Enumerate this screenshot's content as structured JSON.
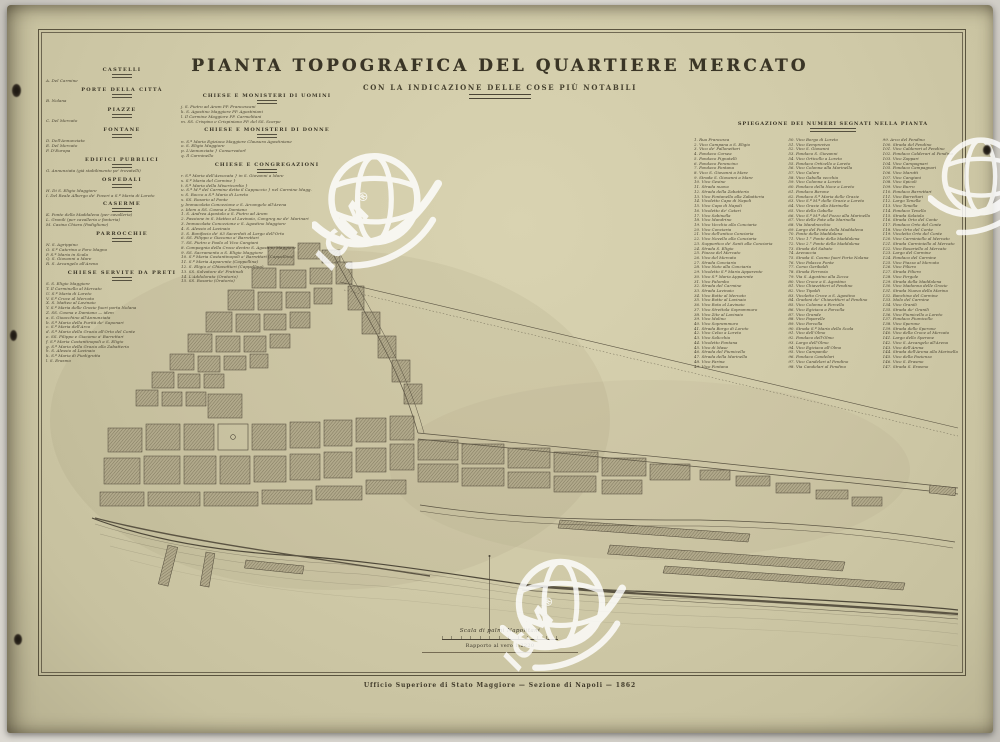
{
  "title": {
    "main": "PIANTA TOPOGRAFICA DEL QUARTIERE MERCATO",
    "subtitle": "CON LA INDICAZIONE DELLE COSE PIÙ NOTABILI"
  },
  "legend_left": {
    "sections": [
      {
        "title": "CASTELLI",
        "items": [
          "A. Del Carmine"
        ]
      },
      {
        "title": "PORTE DELLA CITTÀ",
        "items": [
          "B. Nolana"
        ]
      },
      {
        "title": "PIAZZE",
        "items": [
          "C. Del Mercato"
        ]
      },
      {
        "title": "FONTANE",
        "items": [
          "D. Dell'Annunziata",
          "E. Del Mercato",
          "F. D'Europa"
        ]
      },
      {
        "title": "EDIFICI PUBBLICI",
        "items": [
          "G. Annunziata (già stabilimento pe' trovatelli)"
        ]
      },
      {
        "title": "OSPEDALI",
        "items": [
          "H. Di S. Eligio Maggiore",
          "I. Del Reale Albergo de' Poveri a S.ª Maria di Loreto"
        ]
      },
      {
        "title": "CASERME",
        "items": [
          "K. Ponte della Maddalena (per cavalleria)",
          "L. Granili (per cavalleria e fanteria)",
          "M. Casina Chiara (Padiglione)"
        ]
      },
      {
        "title": "PARROCCHIE",
        "items": [
          "N. S. Agrippino",
          "O. S.ª Caterina a Foro Magno",
          "P. S.ª Maria in Scala",
          "Q. S. Giovanni a Mare",
          "R. S. Arcangelo all'Arena"
        ]
      },
      {
        "title": "CHIESE SERVITE DA PRETI",
        "items": [
          "S. S. Eligio Maggiore",
          "T. Il Carminello al Mercato",
          "U. S.ª Maria di Loreto",
          "V. S.ª Croce al Mercato",
          "X. S. Matteo al Lavinaio",
          "Y. S.ª Maria delle Grazie fuori porta Nolana",
          "Z. SS. Cosma e Damiano — idem",
          "a. S. Gioacchino all'Annunziata",
          "b. S.ª Maria della Purità de' Saponari",
          "c. S.ª Maria dell'Arco",
          "d. S.ª Maria della Grazia all'Orto del Conte",
          "e. SS. Filippo e Giacomo a' Barrettari",
          "f. S.ª Maria Costantinopoli a S. Eligio",
          "g. S.ª Maria della Grazia alla Zabatteria",
          "h. S. Alessio al Lavinaio",
          "k. S.ª Maria di Piedigrotta",
          "l. S. Erasmo"
        ]
      }
    ]
  },
  "center_lists": {
    "sections": [
      {
        "title": "CHIESE E MONISTERI DI UOMINI",
        "items": [
          "j. S. Pietro ad Aram PP. Francescani",
          "k. S. Agostino Maggiore PP. Agostiniani",
          "l. Il Carmine Maggiore PP. Carmelitani",
          "m. SS. Crispino e Crispiniano PP. del SS. Scarpe"
        ]
      },
      {
        "title": "CHIESE E MONISTERI DI DONNE",
        "items": [
          "n. S.ª Maria Egiziaca Maggiore Clausura Agostiniane",
          "o. S. Eligio Maggiore",
          "p. L'Annunziata   }  Conservatorî",
          "q. Il Carminello"
        ]
      },
      {
        "title": "CHIESE E CONGREGAZIONI",
        "items": [
          "r. S.ª Maria dell'Avvocata   }  in S. Giovanni a Mare",
          "s. S.ª Maria del Carmine   }",
          "t. S.ª Maria della Misericordia   }",
          "u. S.ª M.ª del Carmine detta il Cappuccio  }  nel Carmine Magg.",
          "v. S. Rocco a S.ª Maria di Loreto",
          "x. SS. Rosario al Ponte",
          "y. Immacolata Concezione e S. Arcangelo all'Arena",
          "z. Idem a SS. Cosma e Damiano",
          "1. S. Andrea Apostolo a S. Pietro ad Aram",
          "2. Passione in S. Matteo al Lavinaio, Congreg.ne de' Marinari",
          "3. Immacolata Concezione e S. Agostino Maggiore",
          "4. S. Alessio al Lavinaio",
          "5. S. Bonifacio de' 63 Sacerdoti al Largo dell'Orto",
          "6. SS. Filippo e Giacomo a' Barrettari",
          "7. SS. Pietro e Paolo al Vico Cangiani",
          "8. Compagnia della Croce dentro S. Agostino Maggiore",
          "9. SS. Sacramento a S. Eligio Maggiore",
          "10. S.ª Maria Costantinopoli a' Barrettari (Cappellina)",
          "11. S.ª Maria Apparente (Cappellina)",
          "12. S. Eligio a' Chiavettieri (Cappellina)",
          "13. SS. Salvatore de' Fratinali",
          "14. L'Addolorata (Oratorio)",
          "15. SS. Rosario (Oratorio)"
        ]
      }
    ]
  },
  "explanation": {
    "header": "SPIEGAZIONE DEI NUMERI SEGNATI NELLA PIANTA",
    "col1": [
      "1. Rua Francesca",
      "2. Vico Campana a S. Eligio",
      "3. Vico de' Pallonettari",
      "4. Fondaco Corsea",
      "5. Fondaco Pignatelli",
      "6. Fondaco Perancino",
      "7. Fondaco Fontana",
      "8. Vico S. Giovanni a Mare",
      "9. Strada S. Giovanni a Mare",
      "10. Vico Gesine",
      "11. Strada nuova",
      "12. Strada della Zabatteria",
      "13. Vico Fontanella alla Zabatteria",
      "14. Vicoletto Capo di Napoli",
      "15. Vico Capo di Napoli",
      "16. Vicoletto de' Catari",
      "17. Vico Sabinella",
      "18. Vico Mandrino",
      "19. Vico Vecchio alla Conciaria",
      "20. Vico Conciaria",
      "21. Vico dell'antica Conciaria",
      "22. Vico Novello alla Conciaria",
      "23. Supportico de' Santi alla Conciaria",
      "24. Strada S. Eligio",
      "25. Piazza del Mercato",
      "26. Vico del Mercato",
      "27. Strada Conciaria",
      "28. Vico Noto alla Conciaria",
      "29. Vicoletto S.ª Maria Apparente",
      "30. Vico S.ª Maria Apparente",
      "31. Vico Palombo",
      "32. Strada del Carmine",
      "33. Strada Lavinaio",
      "34. Vico Botte al Mercato",
      "35. Vico Botte al Lavinaio",
      "36. Vico Rota al Lavinaio",
      "37. Vico Strettola Soprammuro",
      "38. Vico Zite al Lavinaio",
      "39. Vico Molino",
      "40. Vico Soprammuro",
      "41. Strada Borgo di Loreto",
      "42. Vico Celso a Loreto",
      "43. Vico Salicchia",
      "44. Vicoletto Fontana",
      "45. Vico di Mase",
      "46. Strada del Fiumicello",
      "47. Strada della Marinella",
      "48. Vico Farina",
      "49. Vico Fontana"
    ],
    "col2": [
      "50. Vico Borgo di Loreto",
      "51. Vico Sempreviva",
      "52. Vico S. Giovanni",
      "53. Fondaco S. Giovanni",
      "54. Vico Orticello a Loreto",
      "55. Fondaco Orticello a Loreto",
      "56. Vico Colonna alla Marinella",
      "57. Vico Calore",
      "58. Vico Gabella vecchia",
      "59. Vico Colonna a Loreto",
      "60. Fondaco della Noce a Loreto",
      "61. Fondaco Barone",
      "62. Fondaco S.ª Maria delle Grazie",
      "63. Vico S.ª M.ª delle Grazie a Loreto",
      "64. Vico Grazie alla Marinella",
      "65. Vico della Gabella",
      "66. Vico S.ª M.ª del Pozzo alla Marinella",
      "67. Vico delle Fate alla Marinella",
      "68. Via Mandracchio",
      "69. Largo del Ponte della Maddalena",
      "70. Ponte della Maddalena",
      "71. Vico 1.° Ponte della Maddalena",
      "72. Vico 2.° Ponte della Maddalena",
      "73. Strada del Sabato",
      "74. Arenaccia",
      "75. Strada S. Cosmo fuori Porta Nolana",
      "76. Vico Palazzo Ponte",
      "77. Corso Garibaldi",
      "78. Strada Ferrovia",
      "79. Via S. Agostino alla Zecca",
      "80. Vico Croce a S. Agostino",
      "81. Vico Chiavettieri al Pendino",
      "82. Vico Tipaldi",
      "83. Vicoletto Croce a S. Agostino",
      "84. Gradoni de' Chiavettieri al Pendino",
      "85. Vico Colonna a Forcella",
      "86. Vico Egiziaca a Forcella",
      "87. Vico Grande",
      "88. Vico Paparelle",
      "89. Vico Forcella",
      "90. Strada S.ª Maria della Scala",
      "91. Vico dell'Olmo",
      "92. Fondaco dell'Olmo",
      "93. Largo dell'Olmo",
      "94. Vico Egiziaca all'Olmo",
      "95. Vico Campanile",
      "96. Fondaco Candelari",
      "97. Vico Candelari al Pendino",
      "98. Via Candelari al Pendino"
    ],
    "col3": [
      "99. Arco del Pendino",
      "100. Strada del Pendino",
      "101. Vico Calderari al Pendino",
      "102. Fondaco Calderari al Pendino",
      "103. Vico Zappari",
      "104. Vico Campagnari",
      "105. Fondaco Campagnari",
      "106. Vico Marotti",
      "107. Vico Cangiani",
      "108. Vico Spicoli",
      "109. Vico Burro",
      "110. Fondaco Barrettari",
      "111. Vico Barrettari",
      "112. Largo Tenella",
      "113. Vico Tenella",
      "114. Fondaco Tenella",
      "115. Strada Salaiola",
      "116. Strada Orto del Conte",
      "117. Fondaco Orto del Conte",
      "118. Vico Orto del Conte",
      "119. Vicoletto Orto del Conte",
      "120. Vico Carminiello al Mercato",
      "121. Strada Carminiello al Mercato",
      "122. Vico Rosariello al Mercato",
      "123. Largo del Carmine",
      "124. Fondaco del Carmine",
      "125. Vico Piazza al Mercato",
      "126. Vico Piliero",
      "127. Strada Piliero",
      "128. Vico Pergole",
      "129. Strada della Maddalena",
      "130. Vico Madonna delle Grazie",
      "131. Strada Nuova della Marina",
      "132. Banchina del Carmine",
      "133. Molo del Carmine",
      "134. Vico Granili",
      "135. Strada de' Granili",
      "136. Vico Fiumicello a Loreto",
      "137. Fondaco Fiumicello",
      "138. Vico Sperone",
      "139. Strada dello Sperone",
      "140. Vico della Croce al Mercato",
      "141. Largo dello Sperone",
      "142. Vico S. Arcangelo all'Arena",
      "143. Vico dell'Arena",
      "144. Strada dell'Arena alla Marinella",
      "145. Vico della Pazienza",
      "146. Vico S. Erasmo",
      "147. Strada S. Erasmo"
    ]
  },
  "scale": {
    "label": "Scala di palmi Napolitani",
    "ratio": "Rapporto al vero 1:2220"
  },
  "imprint": {
    "text": "Ufficio Superiore di Stato Maggiore — Sezione di Napoli — 1862"
  },
  "watermark": {
    "text": "IGM",
    "reg": "®"
  }
}
